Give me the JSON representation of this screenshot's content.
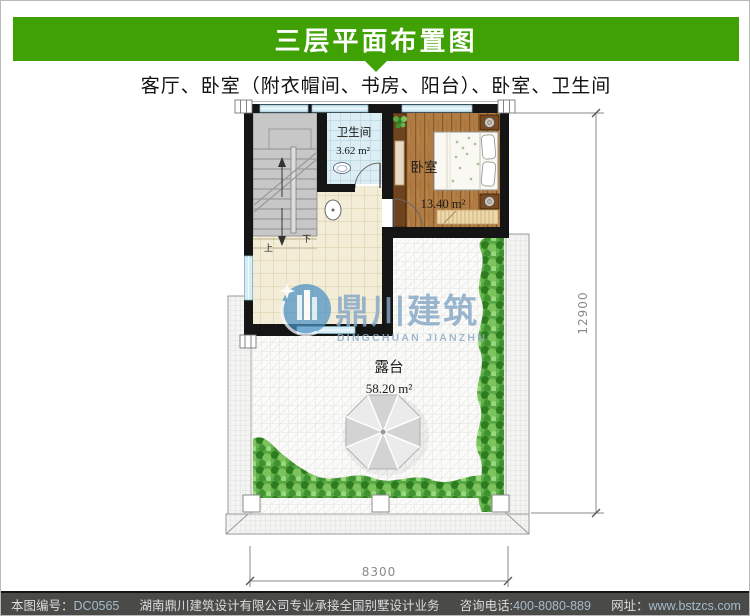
{
  "header": {
    "title": "三层平面布置图",
    "accent_color": "#3fa104"
  },
  "subtitle": {
    "text": "客厅、卧室（附衣帽间、书房、阳台）、卧室、卫生间"
  },
  "plan": {
    "rooms": [
      {
        "name": "卫生间",
        "area": "3.62 m²"
      },
      {
        "name": "卧室",
        "area": "13.40 m²"
      },
      {
        "name": "露台",
        "area": "58.20 m²"
      }
    ],
    "stairs": {
      "up": "上",
      "down": "下"
    },
    "dimensions": {
      "width": "8300",
      "height": "12900"
    }
  },
  "watermark": {
    "name": "鼎川建筑",
    "latin": "DINGCHUAN JIANZHU"
  },
  "footer": {
    "plan_no_label": "本图编号：",
    "plan_no": "DC0565",
    "company": "湖南鼎川建筑设计有限公司专业承接全国别墅设计业务",
    "phone_label": "咨询电话:",
    "phone": "400-8080-889",
    "web_label": "网址：",
    "web": "www.bstzcs.com"
  }
}
